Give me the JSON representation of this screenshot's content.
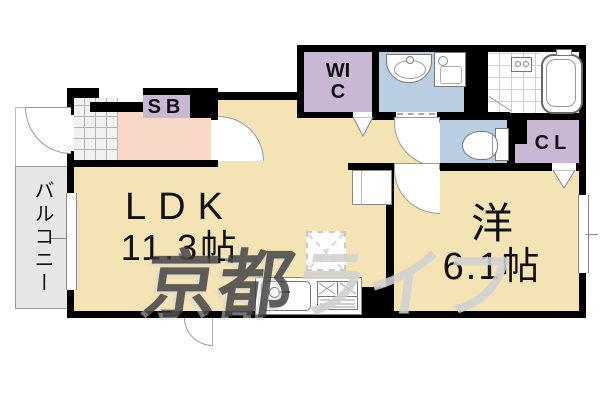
{
  "rooms": {
    "ldk": {
      "label": "LDK",
      "size": "11.3帖"
    },
    "western": {
      "label": "洋",
      "size": "6.1帖"
    },
    "balcony": {
      "label": "バルコニー"
    },
    "wic": {
      "label": "WIC"
    },
    "shoe_box": {
      "label": "SB"
    },
    "closet": {
      "label": "CL"
    }
  },
  "watermark": {
    "left": "京都",
    "right": "ライフ"
  },
  "colors": {
    "room_beige": "#f3e3b5",
    "hall_pink": "#f8d7c7",
    "storage_purple": "#c9b7d3",
    "sanitary_blue": "#b9cfe1",
    "balcony_gray": "#e6e6e6",
    "wall_black": "#000000"
  },
  "fixtures": [
    "bathtub",
    "washbasin",
    "washing-machine-pan",
    "toilet",
    "kitchen-sink",
    "gas-stove",
    "refrigerator-space",
    "entrance-door",
    "window",
    "folding-door"
  ]
}
